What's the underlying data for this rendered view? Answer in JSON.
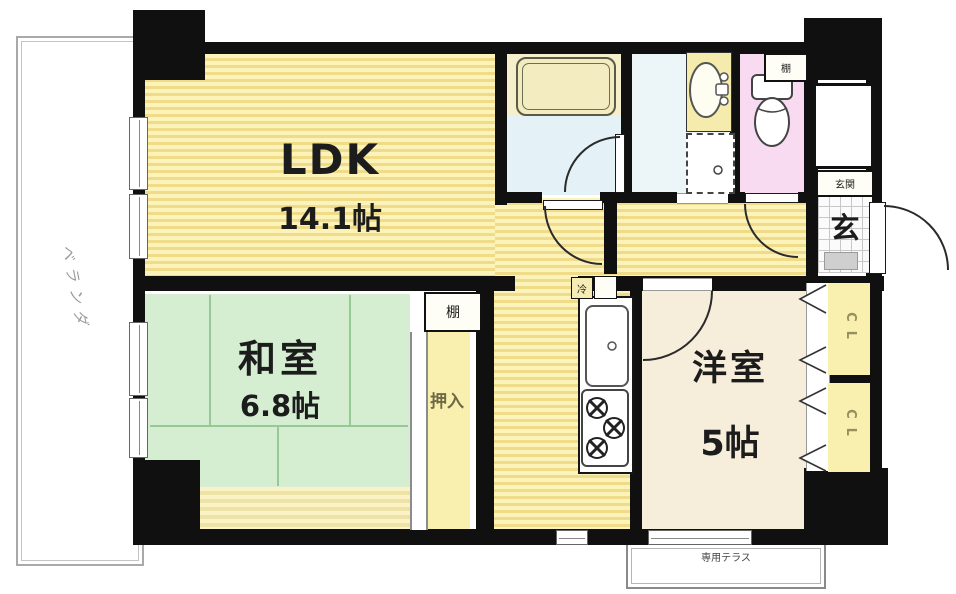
{
  "rooms": {
    "ldk": {
      "name": "LDK",
      "size": "14.1帖"
    },
    "washitsu": {
      "name": "和室",
      "size": "6.8帖"
    },
    "youshitsu": {
      "name": "洋室",
      "size": "5帖"
    },
    "genkan": {
      "symbol": "玄",
      "label": "玄関"
    },
    "oshiire": {
      "label": "押入"
    },
    "balcony": {
      "label": "ベランダ"
    },
    "terrace": {
      "label": "専用テラス"
    }
  },
  "closets": [
    {
      "label": "CL"
    },
    {
      "label": "CL"
    }
  ],
  "small_labels": {
    "shelf": "棚",
    "toilet_shelf": "棚",
    "fridge": "冷"
  },
  "colors": {
    "wall": "#101010",
    "floor_yellow_dark": "#f0dc88",
    "floor_yellow_light": "#fcf3bb",
    "tatami_green": "#d5eed2",
    "western_cream": "#f6eedb",
    "bath_blue": "#e4f2f7",
    "toilet_pink": "#f8dbf0",
    "closet_yellow": "#f9efae"
  }
}
